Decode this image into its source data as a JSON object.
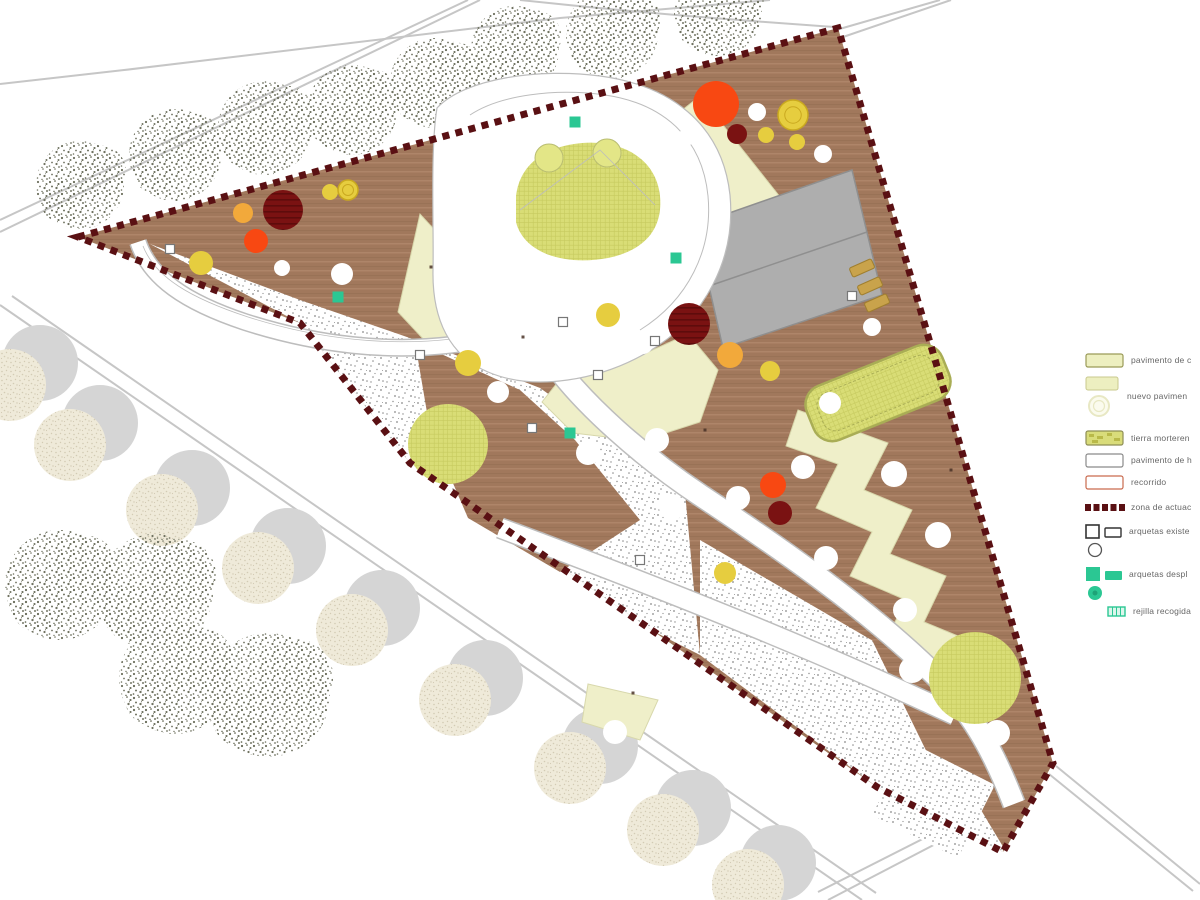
{
  "legend": {
    "items": [
      {
        "id": "pavimento-caucho",
        "label": "pavimento de c",
        "swatch": "pale-rect"
      },
      {
        "id": "nuevo-pavimento",
        "label": "nuevo pavimen",
        "swatch": "pale-rect-with-circle"
      },
      {
        "id": "tierra-morterenca",
        "label": "tierra morteren",
        "swatch": "textured-rect"
      },
      {
        "id": "pavimento-hormigon",
        "label": "pavimento de h",
        "swatch": "white-rect"
      },
      {
        "id": "recorrido",
        "label": "recorrido",
        "swatch": "red-outline-rect"
      },
      {
        "id": "zona-actuacion",
        "label": "zona de actuac",
        "swatch": "dark-red-dashes"
      },
      {
        "id": "arquetas-existentes",
        "label": "arquetas existe",
        "swatch": "black-outline-shapes"
      },
      {
        "id": "arquetas-desplazadas",
        "label": "arquetas despl",
        "swatch": "green-filled-shapes"
      },
      {
        "id": "rejilla-recogida",
        "label": "rejilla recogida",
        "swatch": "green-grid-rect"
      }
    ]
  },
  "colors": {
    "deck": "#A1785C",
    "deck-light": "#AE8569",
    "deck-dark": "#8C664C",
    "stipple-dot": "#8A8A8A",
    "lime": "#D9DD76",
    "lime-line": "#C4C85C",
    "mound": "#E3E687",
    "mound-edge": "#B9BD72",
    "canopy": "#EFEFC9",
    "canopy-edge": "#D8D8AC",
    "path-edge": "#BDBDBD",
    "boundary": "#5A1013",
    "building": "#AEAEAE",
    "building-edge": "#8F8F8F",
    "tree-orange": "#F2A93B",
    "tree-orange-red": "#F84812",
    "tree-dark-red": "#7A1212",
    "tree-dark-red-stripe": "#5E0C0C",
    "tree-yellow": "#E6CD3F",
    "tree-yellow-ring": "#C9A81F",
    "tree-white": "#FFFFFF",
    "teal": "#2BC793",
    "road": "#C6C6C6",
    "sketch": "#6F7260",
    "stree": "#EFEAD9",
    "stree-dot": "#D3CBB4",
    "stree-shadow": "#D5D5D5",
    "sand-edge": "#A9AD55",
    "tan": "#C9A34B",
    "legend-text": "#676767"
  },
  "plan": {
    "trees": {
      "lime": [
        [
          448,
          444,
          40
        ],
        [
          975,
          678,
          46
        ]
      ],
      "orange": [
        [
          243,
          213,
          10
        ],
        [
          730,
          355,
          13
        ]
      ],
      "orange_red": [
        [
          256,
          241,
          12
        ],
        [
          716,
          104,
          23
        ],
        [
          773,
          485,
          13
        ]
      ],
      "dark_red_striped": [
        [
          283,
          210,
          20
        ],
        [
          689,
          324,
          21
        ]
      ],
      "dark_red": [
        [
          737,
          134,
          10
        ],
        [
          780,
          513,
          12
        ]
      ],
      "yellow": [
        [
          330,
          192,
          8
        ],
        [
          201,
          263,
          12
        ],
        [
          468,
          363,
          13
        ],
        [
          608,
          315,
          12
        ],
        [
          766,
          135,
          8
        ],
        [
          797,
          142,
          8
        ],
        [
          770,
          371,
          10
        ],
        [
          725,
          573,
          11
        ]
      ],
      "yellow_ring": [
        [
          793,
          115,
          15
        ],
        [
          348,
          190,
          10
        ]
      ],
      "white": [
        [
          282,
          268,
          8
        ],
        [
          342,
          274,
          11
        ],
        [
          637,
          129,
          10
        ],
        [
          688,
          136,
          9
        ],
        [
          757,
          112,
          9
        ],
        [
          823,
          154,
          9
        ],
        [
          872,
          327,
          9
        ],
        [
          657,
          440,
          12
        ],
        [
          738,
          498,
          12
        ],
        [
          830,
          403,
          11
        ],
        [
          803,
          467,
          12
        ],
        [
          894,
          474,
          13
        ],
        [
          938,
          535,
          13
        ],
        [
          826,
          558,
          12
        ],
        [
          905,
          610,
          12
        ],
        [
          912,
          670,
          13
        ],
        [
          997,
          733,
          13
        ],
        [
          498,
          392,
          11
        ],
        [
          588,
          453,
          12
        ],
        [
          672,
          507,
          13
        ],
        [
          615,
          732,
          12
        ],
        [
          498,
          310,
          9
        ],
        [
          643,
          344,
          10
        ]
      ]
    },
    "outer_trees_sketchy_top": [
      [
        80,
        185,
        44
      ],
      [
        175,
        155,
        46
      ],
      [
        265,
        128,
        47
      ],
      [
        352,
        110,
        45
      ],
      [
        435,
        83,
        45
      ],
      [
        515,
        50,
        44
      ],
      [
        612,
        33,
        46
      ],
      [
        718,
        12,
        44
      ]
    ],
    "outer_trees_sketchy_bottom": [
      [
        60,
        585,
        55
      ],
      [
        155,
        592,
        58
      ],
      [
        175,
        678,
        56
      ],
      [
        268,
        695,
        62
      ]
    ],
    "outer_trees_stippled": [
      [
        10,
        385
      ],
      [
        70,
        445
      ],
      [
        162,
        510
      ],
      [
        258,
        568
      ],
      [
        352,
        630
      ],
      [
        455,
        700
      ],
      [
        570,
        768
      ],
      [
        663,
        830
      ],
      [
        748,
        885
      ]
    ],
    "utility_markers": {
      "teal_squares": [
        [
          575,
          122
        ],
        [
          676,
          258
        ],
        [
          570,
          433
        ],
        [
          338,
          297
        ]
      ],
      "open_squares": [
        [
          420,
          355
        ],
        [
          563,
          322
        ],
        [
          655,
          341
        ],
        [
          532,
          428
        ],
        [
          598,
          375
        ],
        [
          852,
          296
        ],
        [
          640,
          560
        ],
        [
          170,
          249
        ]
      ],
      "dots": [
        [
          523,
          337
        ],
        [
          705,
          430
        ],
        [
          633,
          693
        ],
        [
          951,
          470
        ],
        [
          431,
          267
        ]
      ]
    },
    "equipment_tan": [
      [
        862,
        268
      ],
      [
        870,
        286
      ],
      [
        877,
        303
      ]
    ]
  }
}
